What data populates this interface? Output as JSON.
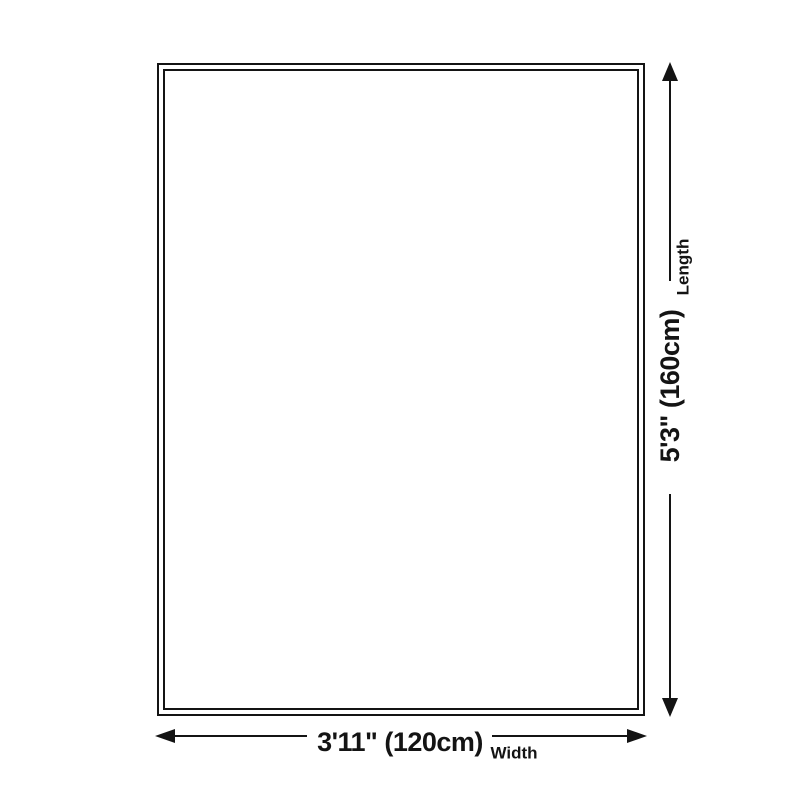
{
  "diagram": {
    "background_color": "#ffffff",
    "line_color": "#141414",
    "length_dimension": {
      "value": "5'3\" (160cm)",
      "axis_label": "Length"
    },
    "width_dimension": {
      "value": "3'11\" (120cm)",
      "axis_label": "Width"
    }
  }
}
